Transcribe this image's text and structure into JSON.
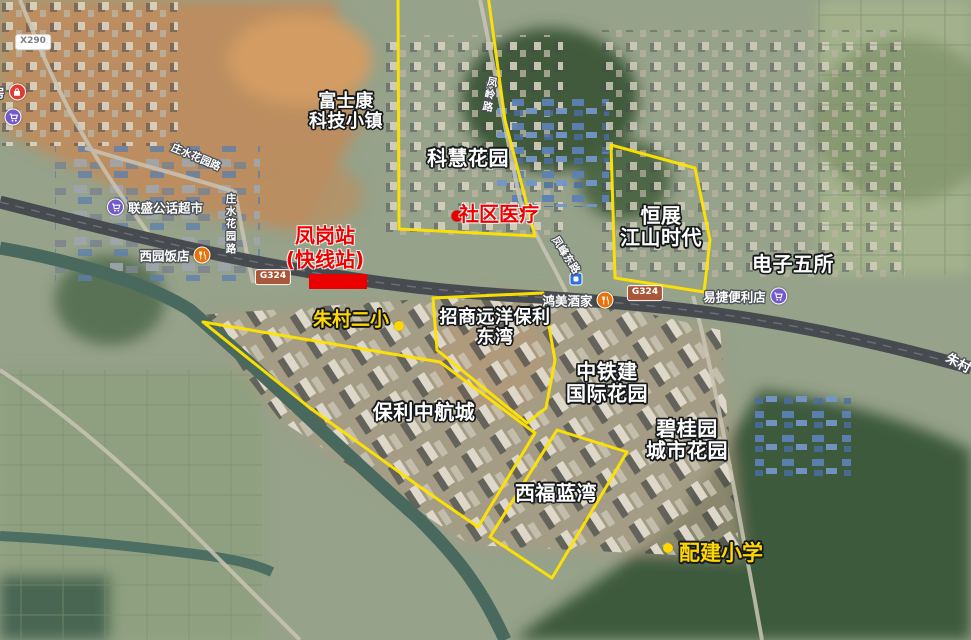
{
  "colors": {
    "annotation_yellow": "#ffe400",
    "annotation_red": "#ea0000",
    "poi_purple": "#7459c8",
    "poi_orange": "#e8710a",
    "poi_red": "#e03c31",
    "road_badge_brown": "#a9573a"
  },
  "estates": [
    {
      "id": "fushikang-tech-town",
      "line1": "富士康",
      "line2": "科技小镇"
    },
    {
      "id": "kehui-garden",
      "line1": "科慧花园",
      "line2": ""
    },
    {
      "id": "hengzhan-jiangshan-era",
      "line1": "恒展",
      "line2": "江山时代"
    },
    {
      "id": "electronics-fifth-institute",
      "line1": "电子五所",
      "line2": ""
    },
    {
      "id": "zhaoshang-yuanyang-baoli-dongwan",
      "line1": "招商远洋保利",
      "line2": "东湾"
    },
    {
      "id": "zhongtiejian-intl-garden",
      "line1": "中铁建",
      "line2": "国际花园"
    },
    {
      "id": "baoli-zhonghang-city",
      "line1": "保利中航城",
      "line2": ""
    },
    {
      "id": "biguiyuan-city-garden",
      "line1": "碧桂园",
      "line2": "城市花园"
    },
    {
      "id": "xifu-lanwan",
      "line1": "西福蓝湾",
      "line2": ""
    }
  ],
  "station": {
    "line1": "凤岗站",
    "line2": "(快线站)"
  },
  "clinic": {
    "label": "社区医疗"
  },
  "schools": {
    "zhucun": "朱村二小",
    "peijian": "配建小学"
  },
  "pois": [
    {
      "name": "联盛公话超市",
      "icon": "cart"
    },
    {
      "name": "西园饭店",
      "icon": "restaurant"
    },
    {
      "name": "鸿美酒家",
      "icon": "restaurant"
    },
    {
      "name": "易捷便利店",
      "icon": "cart"
    },
    {
      "name": "房",
      "icon": "shop"
    }
  ],
  "road_labels": {
    "zhuangshui_huayuan_rd": "庄水花园路",
    "fengling_rd": "凤岭路",
    "fengfeng_east_rd": "凤峰东路",
    "zhucun_partial": "朱村"
  },
  "road_badges": {
    "g324": "G324",
    "x290": "X290"
  }
}
